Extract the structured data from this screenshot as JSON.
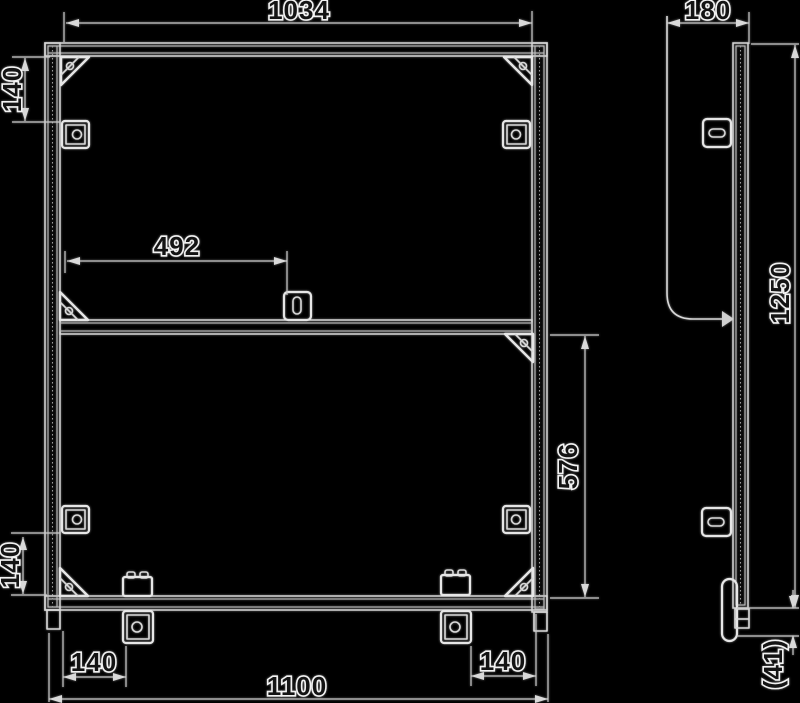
{
  "drawing": {
    "type": "technical-dimension-drawing",
    "background_color": "#000000",
    "line_color": "#d6d6d6",
    "text_style": "white-outlined hollow digits",
    "views": {
      "front": "frame front elevation with corner gussets, slot fittings and rail clamps",
      "side": "upright profile side elevation with support arm and levelling foot"
    }
  },
  "dimensions": {
    "top_width": "1034",
    "side_depth": "180",
    "upper_hole_offset": "140",
    "mid_fitting_offset": "492",
    "side_height": "1250",
    "lower_opening_height": "576",
    "lower_hole_offset": "140",
    "bottom_left_clamp_offset": "140",
    "bottom_right_clamp_offset": "140",
    "overall_width": "1100",
    "foot_height": "(41)"
  }
}
